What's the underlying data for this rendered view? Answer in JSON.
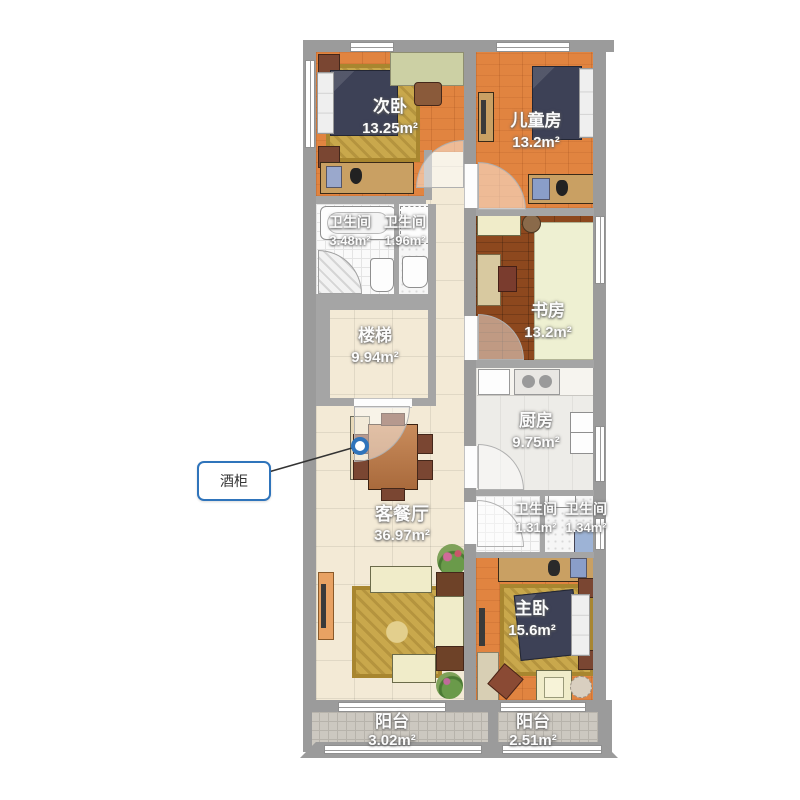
{
  "rooms": [
    {
      "id": "ciwo",
      "name": "次卧",
      "area": "13.25m²"
    },
    {
      "id": "ertongfang",
      "name": "儿童房",
      "area": "13.2m²"
    },
    {
      "id": "weishengjian-a",
      "name": "卫生间",
      "area": "3.48m²"
    },
    {
      "id": "weishengjian-b",
      "name": "卫生间",
      "area": "1.96m²"
    },
    {
      "id": "shufang",
      "name": "书房",
      "area": "13.2m²"
    },
    {
      "id": "louti",
      "name": "楼梯",
      "area": "9.94m²"
    },
    {
      "id": "chufang",
      "name": "厨房",
      "area": "9.75m²"
    },
    {
      "id": "kecanting",
      "name": "客餐厅",
      "area": "36.97m²"
    },
    {
      "id": "weishengjian-c",
      "name": "卫生间",
      "area": "1.31m²"
    },
    {
      "id": "weishengjian-d",
      "name": "卫生间",
      "area": "1.34m²"
    },
    {
      "id": "zhuwo",
      "name": "主卧",
      "area": "15.6m²"
    },
    {
      "id": "yangtai-left",
      "name": "阳台",
      "area": "3.02m²"
    },
    {
      "id": "yangtai-right",
      "name": "阳台",
      "area": "2.51m²"
    }
  ],
  "callout": {
    "label": "酒柜"
  },
  "colors": {
    "wall": "#9b9b9b",
    "wood_orange": "#e18440",
    "wood_dark": "#8d481e",
    "tile_cream": "#f3ead6",
    "balcony_tile": "#ccc8c0",
    "bed_navy": "#3d4156",
    "rug_gold": "#c9a84c",
    "callout_blue": "#2f74bb"
  }
}
